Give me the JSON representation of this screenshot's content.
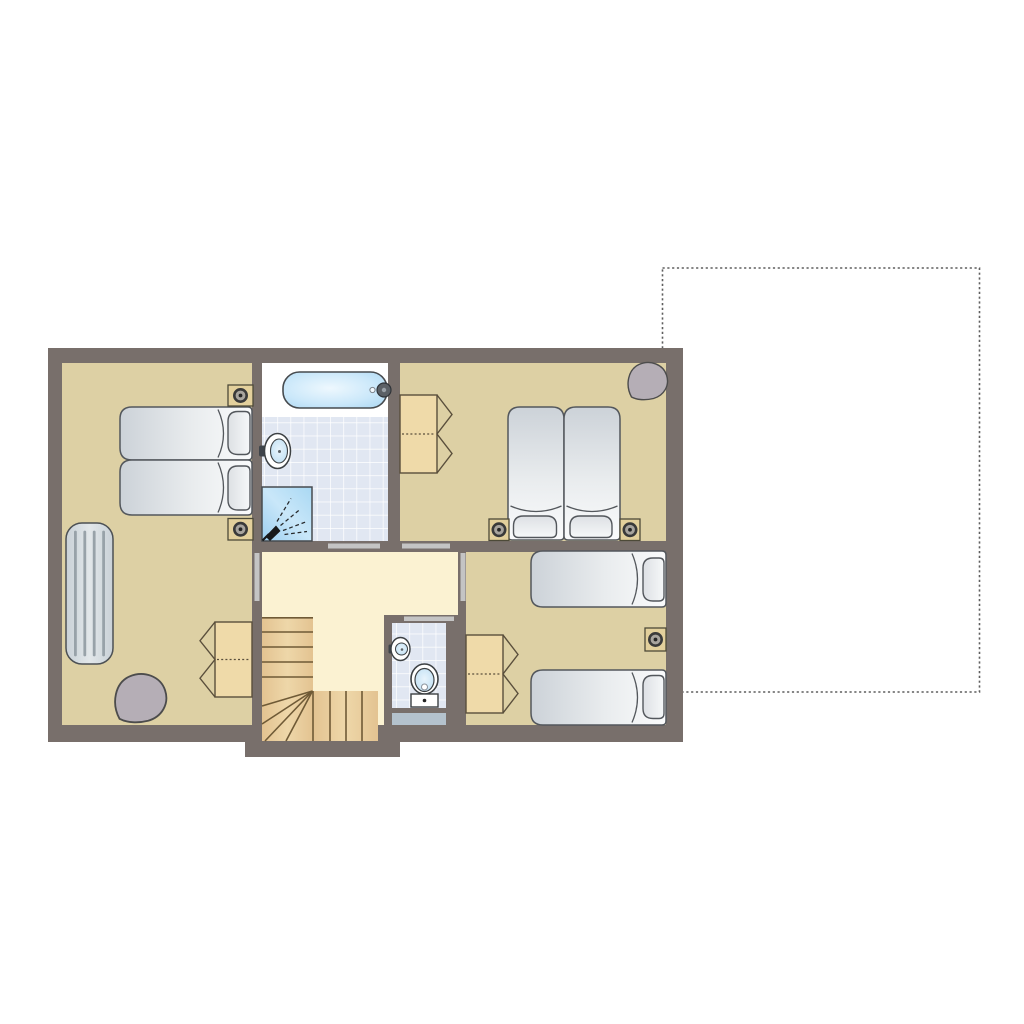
{
  "meta": {
    "title": "upper-floor-plan"
  },
  "colors": {
    "background": "#ffffff",
    "wall": "#786f6b",
    "floor_tan": "#ddd0a4",
    "floor_cream": "#fbf2d2",
    "tile": "#e1e7f2",
    "grout": "#ffffff",
    "wood": "#e9cd9c",
    "wood_line": "#6f5a36",
    "wardrobe": "#efdaa9",
    "wardrobe_line": "#5a4f3c",
    "door_strip": "#c4c4c4",
    "mat": "#b4c2cd",
    "dashed_line": "#5f5f5f",
    "bed_stroke": "#53575c",
    "nightstand": "#e3d09c",
    "nightstand_line": "#4d4a38",
    "lamp_ring": "#3a3a3a",
    "lamp_fill": "#a8a49e",
    "lamp_dot": "#262626",
    "beanbag": "#b5aeb6",
    "beanbag_line": "#4c4c4c",
    "radiator": "#d6dce1",
    "radiator_line": "#98a2a9",
    "fixture_line": "#3c4043",
    "icon_dark": "#17191b",
    "faucet": "#5b6066",
    "white": "#ffffff"
  },
  "dashed_outline": {
    "name": "terrace-outline",
    "x": 662.5,
    "y": 268,
    "w": 317,
    "h": 424
  },
  "building": {
    "slab": {
      "x": 48,
      "y": 348,
      "w": 635,
      "h": 394
    },
    "stair_bay": {
      "x": 245,
      "y": 735,
      "w": 155,
      "h": 22
    }
  },
  "floors": [
    {
      "name": "bedroom-1-floor",
      "x": 62,
      "y": 363,
      "w": 190,
      "h": 362,
      "fill": "floor_tan"
    },
    {
      "name": "bathtub-deck",
      "x": 262,
      "y": 363,
      "w": 126,
      "h": 54,
      "fill": "white"
    },
    {
      "name": "bathroom-tiles",
      "x": 262,
      "y": 417,
      "w": 126,
      "h": 124,
      "fill": "tile",
      "tiled": true
    },
    {
      "name": "bedroom-2-floor",
      "x": 400,
      "y": 363,
      "w": 266,
      "h": 178,
      "fill": "floor_tan"
    },
    {
      "name": "hall-floor",
      "x": 262,
      "y": 552,
      "w": 196,
      "h": 173,
      "fill": "floor_cream"
    },
    {
      "name": "bedroom-3-floor",
      "x": 466,
      "y": 552,
      "w": 200,
      "h": 173,
      "fill": "floor_tan"
    }
  ],
  "wc": {
    "block": {
      "x": 384,
      "y": 615,
      "w": 74,
      "h": 110
    },
    "tiles": {
      "x": 392,
      "y": 623,
      "w": 54,
      "h": 85
    },
    "mat": {
      "x": 392,
      "y": 713,
      "w": 54,
      "h": 12
    }
  },
  "doors": [
    {
      "name": "bathroom-door",
      "x": 328,
      "y": 543.5,
      "w": 52,
      "h": 5
    },
    {
      "name": "bedroom-2-door",
      "x": 402,
      "y": 543.5,
      "w": 48,
      "h": 5
    },
    {
      "name": "bedroom-1-door",
      "x": 254.5,
      "y": 553,
      "w": 5,
      "h": 48
    },
    {
      "name": "bedroom-3-door",
      "x": 460.5,
      "y": 553,
      "w": 5,
      "h": 48
    },
    {
      "name": "wc-door",
      "x": 404,
      "y": 616.5,
      "w": 50,
      "h": 4.5
    }
  ],
  "stairs": {
    "upper": {
      "x": 262,
      "y": 617,
      "w": 51,
      "h": 124
    },
    "lower": {
      "x": 313,
      "y": 691,
      "w": 65,
      "h": 50
    },
    "treads_y": [
      632,
      647,
      662,
      677
    ],
    "treads_x": [
      330,
      346,
      362
    ],
    "fan": {
      "ox": 312.5,
      "oy": 691,
      "ends": [
        [
          262,
          706
        ],
        [
          262,
          724
        ],
        [
          265,
          741
        ],
        [
          286,
          741
        ]
      ]
    }
  },
  "furniture": [
    {
      "type": "bed",
      "name": "bedroom-1-single-bed-a",
      "x": 120,
      "y": 407,
      "w": 132,
      "h": 53,
      "dir": "right",
      "pillow": {
        "x": 228,
        "y": 411.5,
        "w": 22,
        "h": 43
      }
    },
    {
      "type": "bed",
      "name": "bedroom-1-single-bed-b",
      "x": 120,
      "y": 460,
      "w": 132,
      "h": 55,
      "dir": "right",
      "pillow": {
        "x": 228,
        "y": 466,
        "w": 22,
        "h": 44
      }
    },
    {
      "type": "nightstand",
      "name": "bedroom-1-nightstand-top",
      "x": 228,
      "y": 385,
      "w": 25,
      "h": 21
    },
    {
      "type": "nightstand",
      "name": "bedroom-1-nightstand-bottom",
      "x": 228,
      "y": 518.5,
      "w": 25,
      "h": 21.5
    },
    {
      "type": "radiator",
      "name": "bedroom-1-radiator",
      "x": 66,
      "y": 523,
      "w": 47,
      "h": 141
    },
    {
      "type": "wardrobe",
      "name": "bedroom-1-wardrobe",
      "x": 215,
      "y": 622,
      "w": 37,
      "h": 75,
      "doors": "left"
    },
    {
      "type": "beanbag",
      "name": "bedroom-1-beanbag",
      "cx": 141,
      "cy": 698,
      "s": 1.3
    },
    {
      "type": "wardrobe",
      "name": "bedroom-2-wardrobe",
      "x": 400,
      "y": 395,
      "w": 37,
      "h": 78,
      "doors": "right"
    },
    {
      "type": "bed",
      "name": "bedroom-2-single-bed-a",
      "x": 508,
      "y": 407,
      "w": 56,
      "h": 133,
      "dir": "down",
      "pillow": {
        "x": 513.5,
        "y": 516,
        "w": 43,
        "h": 21.5
      }
    },
    {
      "type": "bed",
      "name": "bedroom-2-single-bed-b",
      "x": 564,
      "y": 407,
      "w": 56,
      "h": 133,
      "dir": "down",
      "pillow": {
        "x": 570,
        "y": 516,
        "w": 42,
        "h": 21.5
      }
    },
    {
      "type": "nightstand",
      "name": "bedroom-2-nightstand-left",
      "x": 489,
      "y": 519,
      "w": 20,
      "h": 21.5
    },
    {
      "type": "nightstand",
      "name": "bedroom-2-nightstand-right",
      "x": 620,
      "y": 519,
      "w": 20,
      "h": 21.5
    },
    {
      "type": "beanbag",
      "name": "bedroom-2-beanbag",
      "cx": 648,
      "cy": 381,
      "s": 1.0
    },
    {
      "type": "wardrobe",
      "name": "bedroom-3-wardrobe",
      "x": 466,
      "y": 635,
      "w": 37,
      "h": 78,
      "doors": "right"
    },
    {
      "type": "bed",
      "name": "bedroom-3-single-bed-a",
      "x": 531,
      "y": 551,
      "w": 135,
      "h": 56,
      "dir": "right",
      "pillow": {
        "x": 643,
        "y": 558,
        "w": 21,
        "h": 43
      }
    },
    {
      "type": "bed",
      "name": "bedroom-3-single-bed-b",
      "x": 531,
      "y": 670,
      "w": 135,
      "h": 55,
      "dir": "right",
      "pillow": {
        "x": 643,
        "y": 675.5,
        "w": 21,
        "h": 43
      }
    },
    {
      "type": "nightstand",
      "name": "bedroom-3-nightstand",
      "x": 645,
      "y": 628,
      "w": 21,
      "h": 23
    }
  ],
  "fixtures": {
    "bathtub": {
      "x": 283,
      "y": 372,
      "w": 104,
      "h": 36,
      "faucet_cx": 384,
      "faucet_cy": 390,
      "drain_cx": 372.5
    },
    "bathroom_sink": {
      "cx": 277.5,
      "cy": 451
    },
    "shower": {
      "x": 262,
      "y": 487,
      "w": 50,
      "h": 54
    },
    "toilet": {
      "cx": 424.5,
      "cy": 679
    },
    "wc_sink": {
      "cx": 400.5,
      "cy": 649
    }
  }
}
